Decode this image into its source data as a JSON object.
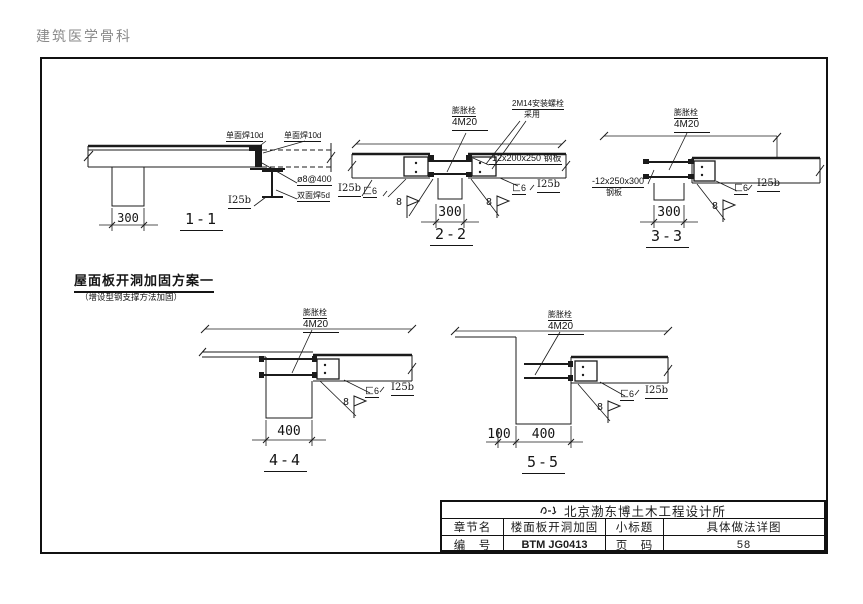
{
  "page": {
    "watermark": "建筑医学骨科"
  },
  "scheme": {
    "title": "屋面板开洞加固方案一",
    "subtitle": "（增设型钢支撑方法加固）"
  },
  "sections": {
    "s11": {
      "title": "1-1",
      "dim": "300",
      "labels": {
        "weld_top_left": "单面焊10d",
        "weld_top_right": "单面焊10d",
        "rebar": "ø8@400",
        "weld_bottom": "双面焊5d",
        "ibeam": "I25b"
      }
    },
    "s22": {
      "title": "2-2",
      "dim": "300",
      "labels": {
        "anchor_name": "膨胀栓",
        "anchor_spec": "4M20",
        "bolt_line1": "2M14安装螺栓",
        "bolt_line2": "采用",
        "plate": "-12x200x250 钢板",
        "ibeam_left": "I25b",
        "channel_left": "匚6",
        "channel_right": "匚6",
        "ibeam_right": "I25b",
        "weld_size": "8"
      }
    },
    "s33": {
      "title": "3-3",
      "dim": "300",
      "labels": {
        "anchor_name": "膨胀栓",
        "anchor_spec": "4M20",
        "plate_line1": "-12x250x300",
        "plate_line2": "钢板",
        "channel": "匚6",
        "ibeam": "I25b",
        "weld_size": "8"
      }
    },
    "s44": {
      "title": "4-4",
      "dim": "400",
      "labels": {
        "anchor_name": "膨胀栓",
        "anchor_spec": "4M20",
        "channel": "匚6",
        "ibeam": "I25b",
        "weld_size": "8"
      }
    },
    "s55": {
      "title": "5-5",
      "dim_offset": "100",
      "dim": "400",
      "labels": {
        "anchor_name": "膨胀栓",
        "anchor_spec": "4M20",
        "channel": "匚6",
        "ibeam": "I25b",
        "weld_size": "8"
      }
    }
  },
  "title_block": {
    "company": "北京渤东博土木工程设计所",
    "chapter_label": "章节名",
    "chapter_value": "楼面板开洞加固",
    "subtitle_label": "小标题",
    "subtitle_value": "具体做法详图",
    "number_label": "编　号",
    "number_value": "BTM JG0413",
    "page_label": "页　码",
    "page_value": "58"
  }
}
